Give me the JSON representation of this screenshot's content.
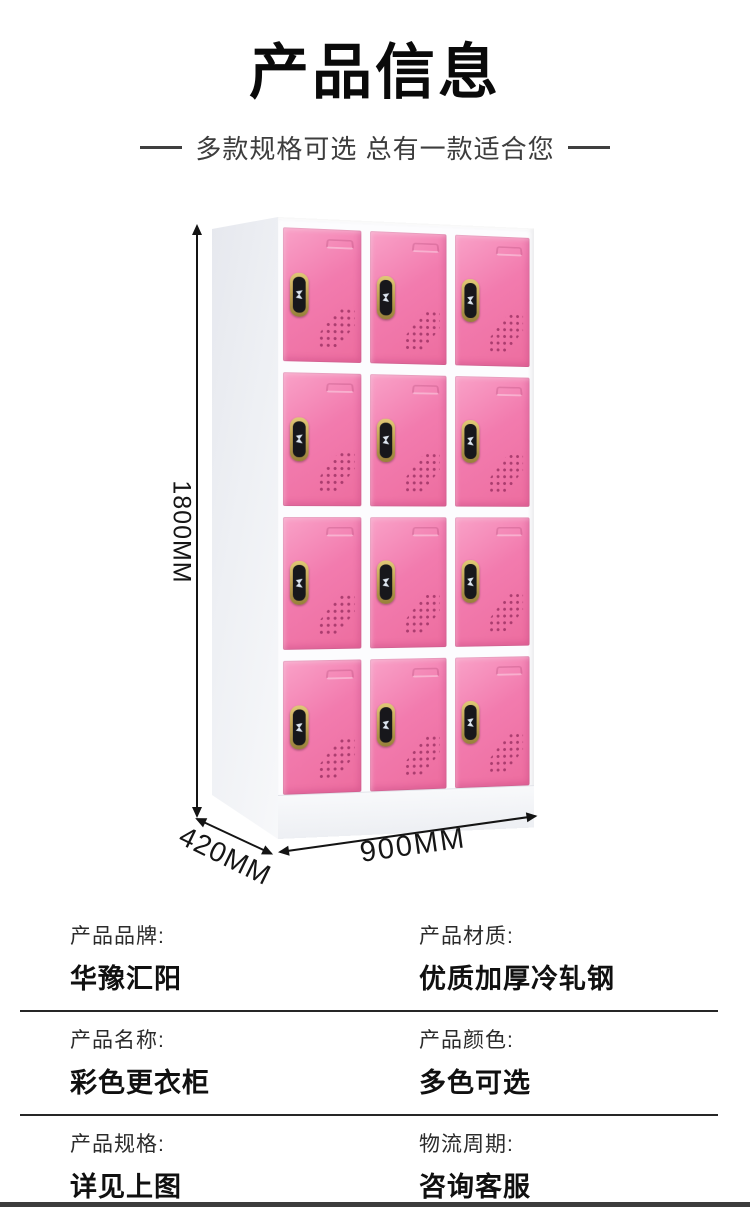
{
  "header": {
    "title": "产品信息",
    "subtitle": "多款规格可选 总有一款适合您"
  },
  "figure": {
    "description": "12-door pink steel changing locker, white frame, electronic locks",
    "locker": {
      "rows": 4,
      "columns": 3,
      "door_count": 12
    },
    "dimensions": {
      "height_label": "1800MM",
      "depth_label": "420MM",
      "width_label": "900MM"
    },
    "colors": {
      "door_pink": "#f27bae",
      "door_pink_light": "#f9a2c8",
      "door_pink_dark": "#ed6d9f",
      "frame_white": "#fcfcfe",
      "side_gray": "#e6e8ee",
      "lock_gold": "#c2a455",
      "lock_face": "#17171b",
      "line_black": "#141414"
    }
  },
  "spec_table": {
    "rows": [
      {
        "cells": [
          {
            "label": "产品品牌:",
            "value": "华豫汇阳"
          },
          {
            "label": "产品材质:",
            "value": "优质加厚冷轧钢"
          }
        ]
      },
      {
        "cells": [
          {
            "label": "产品名称:",
            "value": "彩色更衣柜"
          },
          {
            "label": "产品颜色:",
            "value": "多色可选"
          }
        ]
      },
      {
        "cells": [
          {
            "label": "产品规格:",
            "value": "详见上图"
          },
          {
            "label": "物流周期:",
            "value": "咨询客服"
          }
        ]
      }
    ]
  }
}
